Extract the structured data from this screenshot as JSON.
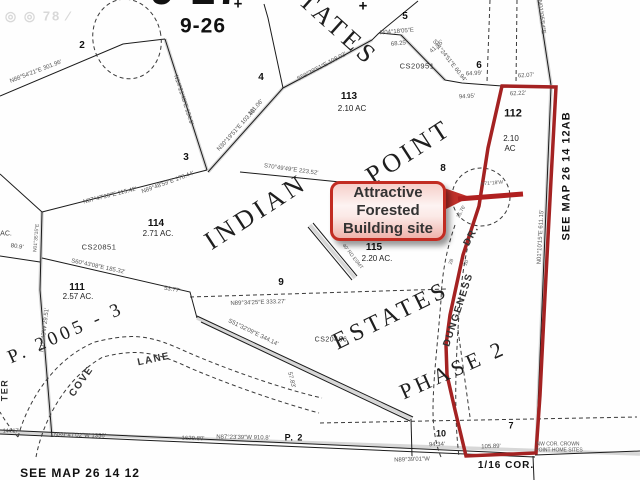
{
  "watermark": {
    "text": "◎ ◎ 78 ∕"
  },
  "callout": {
    "line1": "Attractive",
    "line2": "Forested",
    "line3": "Building site"
  },
  "colors": {
    "highlight_red": "#a42222",
    "callout_border": "#c22c22",
    "line_black": "#1b1b1b"
  },
  "map_refs": {
    "bottom": "SEE MAP 26 14 12",
    "right": "SEE MAP 26 14 12AB",
    "sixteenth_corner": "1/16 COR.",
    "page": "P. 2",
    "partition": "P. 2005 - 3",
    "plat_upper": "9-27",
    "plat_number": "9-26"
  },
  "labels": [
    {
      "t": "◎ ◎ 78 ∕",
      "x": 38,
      "y": 16,
      "r": 0,
      "s": 13,
      "c": "wm",
      "n": "photo-watermark"
    },
    {
      "t": "9-27",
      "x": 196,
      "y": -10,
      "r": 0,
      "s": 44,
      "c": "plat",
      "n": "plat-number-9-27"
    },
    {
      "t": "9-26",
      "x": 203,
      "y": 26,
      "r": 0,
      "s": 21,
      "c": "plat",
      "n": "plat-number-9-26"
    },
    {
      "t": "+",
      "x": 238,
      "y": 4,
      "r": 0,
      "s": 15,
      "c": "blk",
      "n": "section-corner-mark"
    },
    {
      "t": "+",
      "x": 363,
      "y": 6,
      "r": 0,
      "s": 15,
      "c": "blk",
      "n": "section-corner-mark-2"
    },
    {
      "t": "ESTATES",
      "x": 324,
      "y": 16,
      "r": 42,
      "s": 26,
      "c": "big",
      "n": "plat-name-estates-top"
    },
    {
      "t": "INDIAN",
      "x": 256,
      "y": 212,
      "r": -33,
      "s": 26,
      "c": "big",
      "n": "plat-name-indian"
    },
    {
      "t": "POINT",
      "x": 409,
      "y": 152,
      "r": -33,
      "s": 26,
      "c": "big",
      "n": "plat-name-point"
    },
    {
      "t": "ESTATES",
      "x": 391,
      "y": 316,
      "r": -26,
      "s": 24,
      "c": "big",
      "n": "plat-name-estates"
    },
    {
      "t": "PHASE 2",
      "x": 453,
      "y": 370,
      "r": -24,
      "s": 22,
      "c": "big",
      "n": "phase-2-label"
    },
    {
      "t": "P. 2005 - 3",
      "x": 66,
      "y": 333,
      "r": -24,
      "s": 19,
      "c": "big",
      "n": "partition-2005-3-label"
    },
    {
      "t": "2",
      "x": 82,
      "y": 46,
      "r": 0,
      "s": 10,
      "c": "blk",
      "n": "lot-number-2"
    },
    {
      "t": "3",
      "x": 186,
      "y": 158,
      "r": 0,
      "s": 10,
      "c": "blk",
      "n": "lot-number-3"
    },
    {
      "t": "4",
      "x": 261,
      "y": 78,
      "r": 0,
      "s": 10,
      "c": "blk",
      "n": "lot-number-4"
    },
    {
      "t": "5",
      "x": 405,
      "y": 17,
      "r": 0,
      "s": 10,
      "c": "blk",
      "n": "lot-number-5"
    },
    {
      "t": "6",
      "x": 479,
      "y": 66,
      "r": 0,
      "s": 10,
      "c": "blk",
      "n": "lot-number-6"
    },
    {
      "t": "8",
      "x": 443,
      "y": 169,
      "r": 0,
      "s": 10,
      "c": "blk",
      "n": "lot-number-8"
    },
    {
      "t": "9",
      "x": 281,
      "y": 283,
      "r": 0,
      "s": 10,
      "c": "blk",
      "n": "lot-number-9"
    },
    {
      "t": "10",
      "x": 441,
      "y": 434,
      "r": 0,
      "s": 9,
      "c": "blk",
      "n": "lot-number-10"
    },
    {
      "t": "7",
      "x": 511,
      "y": 426,
      "r": 0,
      "s": 9,
      "c": "blk",
      "n": "lot-number-7"
    },
    {
      "t": "112",
      "x": 513,
      "y": 114,
      "r": 0,
      "s": 11,
      "c": "blk",
      "n": "lot-number-112"
    },
    {
      "t": "113",
      "x": 349,
      "y": 97,
      "r": 0,
      "s": 10,
      "c": "blk",
      "n": "lot-number-113"
    },
    {
      "t": "114",
      "x": 156,
      "y": 224,
      "r": 0,
      "s": 10,
      "c": "blk",
      "n": "lot-number-114"
    },
    {
      "t": "115",
      "x": 374,
      "y": 248,
      "r": 0,
      "s": 10,
      "c": "blk",
      "n": "lot-number-115"
    },
    {
      "t": "111",
      "x": 77,
      "y": 288,
      "r": 0,
      "s": 10,
      "c": "blk",
      "n": "lot-number-111"
    },
    {
      "t": "2.10 AC",
      "x": 352,
      "y": 109,
      "r": 0,
      "s": 8,
      "c": "ac",
      "n": "lot-113-acreage"
    },
    {
      "t": "2.10",
      "x": 511,
      "y": 139,
      "r": 0,
      "s": 8,
      "c": "ac",
      "n": "lot-112-acreage"
    },
    {
      "t": "AC",
      "x": 510,
      "y": 149,
      "r": 0,
      "s": 8,
      "c": "ac",
      "n": "lot-112-acreage-unit"
    },
    {
      "t": "2.71 AC.",
      "x": 158,
      "y": 234,
      "r": 0,
      "s": 8,
      "c": "ac",
      "n": "lot-114-acreage"
    },
    {
      "t": "2.20 AC.",
      "x": 377,
      "y": 259,
      "r": 0,
      "s": 8,
      "c": "ac",
      "n": "lot-115-acreage"
    },
    {
      "t": "2.57 AC.",
      "x": 78,
      "y": 297,
      "r": 0,
      "s": 8,
      "c": "ac",
      "n": "lot-111-acreage"
    },
    {
      "t": "CS20951",
      "x": 417,
      "y": 66,
      "r": 0,
      "s": 7.5,
      "c": "sur",
      "n": "survey-ref-cs20951"
    },
    {
      "t": "CS20851",
      "x": 99,
      "y": 247,
      "r": 0,
      "s": 7.5,
      "c": "sur",
      "n": "survey-ref-cs20851"
    },
    {
      "t": "CS20466",
      "x": 331,
      "y": 340,
      "r": 0,
      "s": 7,
      "c": "sur",
      "n": "survey-ref-cs20466"
    },
    {
      "t": "SEE MAP 26 14 12",
      "x": 80,
      "y": 473,
      "r": 0,
      "s": 12,
      "c": "ref",
      "n": "see-map-bottom"
    },
    {
      "t": "SEE MAP 26 14 12AB",
      "x": 567,
      "y": 176,
      "r": -90,
      "s": 11,
      "c": "ref",
      "n": "see-map-right"
    },
    {
      "t": "1/16 COR.",
      "x": 506,
      "y": 466,
      "r": 0,
      "s": 10,
      "c": "ref",
      "n": "sixteenth-corner-label"
    },
    {
      "t": "P. 2",
      "x": 294,
      "y": 438,
      "r": 0,
      "s": 9,
      "c": "ref",
      "n": "page-2-label"
    },
    {
      "t": "NW COR. CROWN",
      "x": 558,
      "y": 445,
      "r": 0,
      "s": 5,
      "c": "br",
      "n": "nw-corner-note-line1"
    },
    {
      "t": "POINT HOME SITES",
      "x": 559,
      "y": 451,
      "r": 0,
      "s": 5,
      "c": "br",
      "n": "nw-corner-note-line2"
    },
    {
      "t": "DUNGENESS",
      "x": 459,
      "y": 310,
      "r": -72,
      "s": 10,
      "c": "road",
      "n": "road-label-dungeness"
    },
    {
      "t": "DR.",
      "x": 472,
      "y": 236,
      "r": -62,
      "s": 10,
      "c": "road",
      "n": "road-label-dr"
    },
    {
      "t": "COVE",
      "x": 82,
      "y": 382,
      "r": -55,
      "s": 10,
      "c": "road",
      "n": "road-label-cove"
    },
    {
      "t": "LANE",
      "x": 154,
      "y": 360,
      "r": -12,
      "s": 10,
      "c": "road",
      "n": "road-label-lane"
    },
    {
      "t": "TER",
      "x": 5,
      "y": 390,
      "r": -90,
      "s": 9,
      "c": "road",
      "n": "road-label-ter-fragment"
    },
    {
      "t": "N88°54'21″E 301.96'",
      "x": 36,
      "y": 72,
      "r": -21,
      "s": 6,
      "c": "br",
      "n": "bearing-label"
    },
    {
      "t": "N14°21'40″E 134.9'",
      "x": 183,
      "y": 100,
      "r": 72,
      "s": 6,
      "c": "br",
      "n": "bearing-label"
    },
    {
      "t": "N30°19'51″E 103.46'",
      "x": 237,
      "y": 130,
      "r": -48,
      "s": 6,
      "c": "br",
      "n": "bearing-label"
    },
    {
      "t": "101.06'",
      "x": 256,
      "y": 108,
      "r": -48,
      "s": 6,
      "c": "br",
      "n": "distance-label"
    },
    {
      "t": "S59°39'51″E 108.02'",
      "x": 322,
      "y": 67,
      "r": -28,
      "s": 6,
      "c": "br",
      "n": "bearing-label"
    },
    {
      "t": "N04°18'05″E",
      "x": 397,
      "y": 32,
      "r": -5,
      "s": 6,
      "c": "br",
      "n": "bearing-label"
    },
    {
      "t": "68.25'",
      "x": 399,
      "y": 44,
      "r": -5,
      "s": 6,
      "c": "br",
      "n": "distance-label"
    },
    {
      "t": "41.15'",
      "x": 437,
      "y": 47,
      "r": -42,
      "s": 6,
      "c": "br",
      "n": "distance-label"
    },
    {
      "t": "S01°24'51″E 60.94'",
      "x": 449,
      "y": 61,
      "r": 52,
      "s": 6,
      "c": "br",
      "n": "bearing-label"
    },
    {
      "t": "64.99'",
      "x": 474,
      "y": 74,
      "r": -3,
      "s": 6,
      "c": "br",
      "n": "distance-label"
    },
    {
      "t": "62.07'",
      "x": 526,
      "y": 76,
      "r": -3,
      "s": 6,
      "c": "br",
      "n": "distance-label"
    },
    {
      "t": "94.95'",
      "x": 467,
      "y": 97,
      "r": -3,
      "s": 6,
      "c": "br",
      "n": "distance-label"
    },
    {
      "t": "62.22'",
      "x": 518,
      "y": 94,
      "r": -3,
      "s": 6,
      "c": "br",
      "n": "distance-label"
    },
    {
      "t": "N01°05'54″E",
      "x": 541,
      "y": 17,
      "r": 83,
      "s": 6,
      "c": "br",
      "n": "bearing-label"
    },
    {
      "t": "N87°47'20″E 115.42'",
      "x": 110,
      "y": 196,
      "r": -14,
      "s": 6,
      "c": "br",
      "n": "bearing-label"
    },
    {
      "t": "N89°48'59″E 178.44'",
      "x": 168,
      "y": 183,
      "r": -20,
      "s": 6,
      "c": "br",
      "n": "bearing-label"
    },
    {
      "t": "S70°49'49″E 223.52'",
      "x": 291,
      "y": 170,
      "r": 8,
      "s": 6,
      "c": "br",
      "n": "bearing-label"
    },
    {
      "t": "S60°43'08″E 185.32'",
      "x": 98,
      "y": 267,
      "r": 12,
      "s": 6,
      "c": "br",
      "n": "bearing-label"
    },
    {
      "t": "53.77'",
      "x": 172,
      "y": 290,
      "r": 10,
      "s": 6,
      "c": "br",
      "n": "distance-label"
    },
    {
      "t": "N89°34'25″E 333.27'",
      "x": 258,
      "y": 303,
      "r": -2,
      "s": 6,
      "c": "br",
      "n": "bearing-label"
    },
    {
      "t": "N11°43'W 29.51'",
      "x": 45,
      "y": 330,
      "r": -83,
      "s": 6,
      "c": "br",
      "n": "bearing-label"
    },
    {
      "t": "N01°35'15″E",
      "x": 37,
      "y": 238,
      "r": -85,
      "s": 5,
      "c": "br",
      "n": "bearing-label"
    },
    {
      "t": "N01°10'15″E 611.15'",
      "x": 541,
      "y": 237,
      "r": -87,
      "s": 6,
      "c": "br",
      "n": "bearing-label"
    },
    {
      "t": "N89°47'02″W 1356'",
      "x": 80,
      "y": 436,
      "r": 1,
      "s": 6,
      "c": "br",
      "n": "bearing-label"
    },
    {
      "t": "1629.80'",
      "x": 193,
      "y": 439,
      "r": 1,
      "s": 6,
      "c": "br",
      "n": "distance-label"
    },
    {
      "t": "N87°23'39″W 910.8'",
      "x": 243,
      "y": 438,
      "r": 1,
      "s": 6,
      "c": "br",
      "n": "bearing-label"
    },
    {
      "t": "94.34'",
      "x": 437,
      "y": 445,
      "r": -2,
      "s": 6,
      "c": "br",
      "n": "distance-label"
    },
    {
      "t": "105.89'",
      "x": 491,
      "y": 447,
      "r": -2,
      "s": 6,
      "c": "br",
      "n": "distance-label"
    },
    {
      "t": "N89°39'01″W",
      "x": 412,
      "y": 460,
      "r": -2,
      "s": 6,
      "c": "br",
      "n": "bearing-label"
    },
    {
      "t": "S51°32'09″E 344.14'",
      "x": 253,
      "y": 333,
      "r": 26,
      "s": 6,
      "c": "br",
      "n": "bearing-label"
    },
    {
      "t": "57.83'",
      "x": 291,
      "y": 380,
      "r": 76,
      "s": 6,
      "c": "br",
      "n": "distance-label"
    },
    {
      "t": "40' RD ESMT",
      "x": 352,
      "y": 257,
      "r": 52,
      "s": 5,
      "c": "br",
      "n": "easement-label"
    },
    {
      "t": "N71°18'W",
      "x": 492,
      "y": 184,
      "r": -5,
      "s": 5,
      "c": "br",
      "n": "bearing-label"
    },
    {
      "t": "25.76'",
      "x": 462,
      "y": 212,
      "r": -62,
      "s": 5,
      "c": "br",
      "n": "distance-label"
    },
    {
      "t": "28",
      "x": 452,
      "y": 262,
      "r": -70,
      "s": 5,
      "c": "br",
      "n": "distance-label"
    },
    {
      "t": "20",
      "x": 467,
      "y": 263,
      "r": -70,
      "s": 5,
      "c": "br",
      "n": "distance-label"
    },
    {
      "t": "AC.",
      "x": 6,
      "y": 234,
      "r": 0,
      "s": 7,
      "c": "frag",
      "n": "edge-fragment-acreage"
    },
    {
      "t": "80.9'",
      "x": 17,
      "y": 247,
      "r": 8,
      "s": 6,
      "c": "frag",
      "n": "distance-label"
    },
    {
      "t": "144.17'",
      "x": 11,
      "y": 432,
      "r": 0,
      "s": 5,
      "c": "frag",
      "n": "distance-label"
    }
  ]
}
